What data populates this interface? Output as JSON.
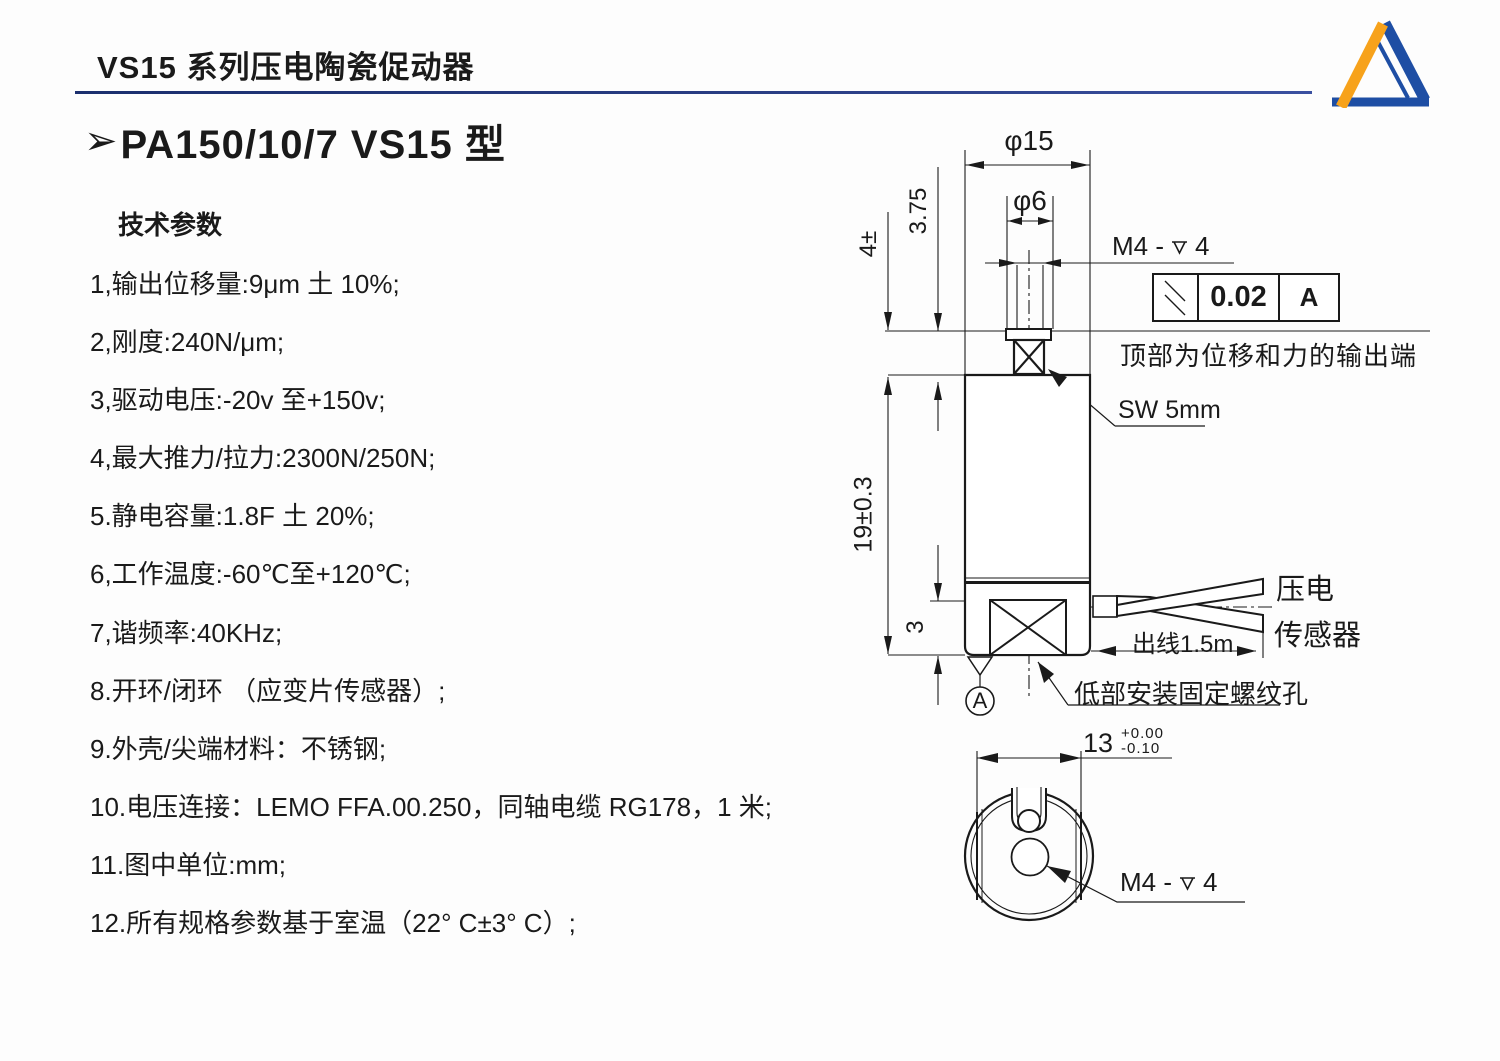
{
  "page": {
    "title": "VS15 系列压电陶瓷促动器"
  },
  "logo": {
    "orange": "#F7A21B",
    "blue": "#1E4EA4"
  },
  "section": {
    "bullet": "➢",
    "heading": "PA150/10/7 VS15 型"
  },
  "specs": {
    "title": "技术参数",
    "items": [
      "1,输出位移量:9μm 土 10%;",
      "2,刚度:240N/μm;",
      "3,驱动电压:-20v 至+150v;",
      "4,最大推力/拉力:2300N/250N;",
      "5.静电容量:1.8F 土 20%;",
      "6,工作温度:-60℃至+120℃;",
      "7,谐频率:40KHz;",
      "8.开环/闭环 （应变片传感器）;",
      "9.外壳/尖端材料：不锈钢;",
      "10.电压连接：LEMO FFA.00.250，同轴电缆 RG178，1 米;",
      "11.图中单位:mm;",
      "12.所有规格参数基于室温（22° C±3° C）;"
    ]
  },
  "drawing": {
    "front": {
      "dim_phi15": "φ15",
      "dim_phi6": "φ6",
      "thread_prefix": "M4 -",
      "thread_depth": "4",
      "tolerance": {
        "value": "0.02",
        "datum": "A"
      },
      "top_note": "顶部为位移和力的输出端",
      "wrench_label": "SW 5mm",
      "dim_stud": "4±",
      "dim_thread_len": "3.75",
      "dim_body": "19±0.3",
      "dim_bottom": "3",
      "datum_label": "A",
      "cable_label": "出线1.5m",
      "sensor_line1": "压电",
      "sensor_line2": "传感器",
      "bottom_hole_note": "低部安装固定螺纹孔"
    },
    "bottom": {
      "dim_width": "13",
      "tol_upper": "+0.00",
      "tol_lower": "-0.10",
      "thread_prefix": "M4 -",
      "thread_depth": "4"
    }
  }
}
